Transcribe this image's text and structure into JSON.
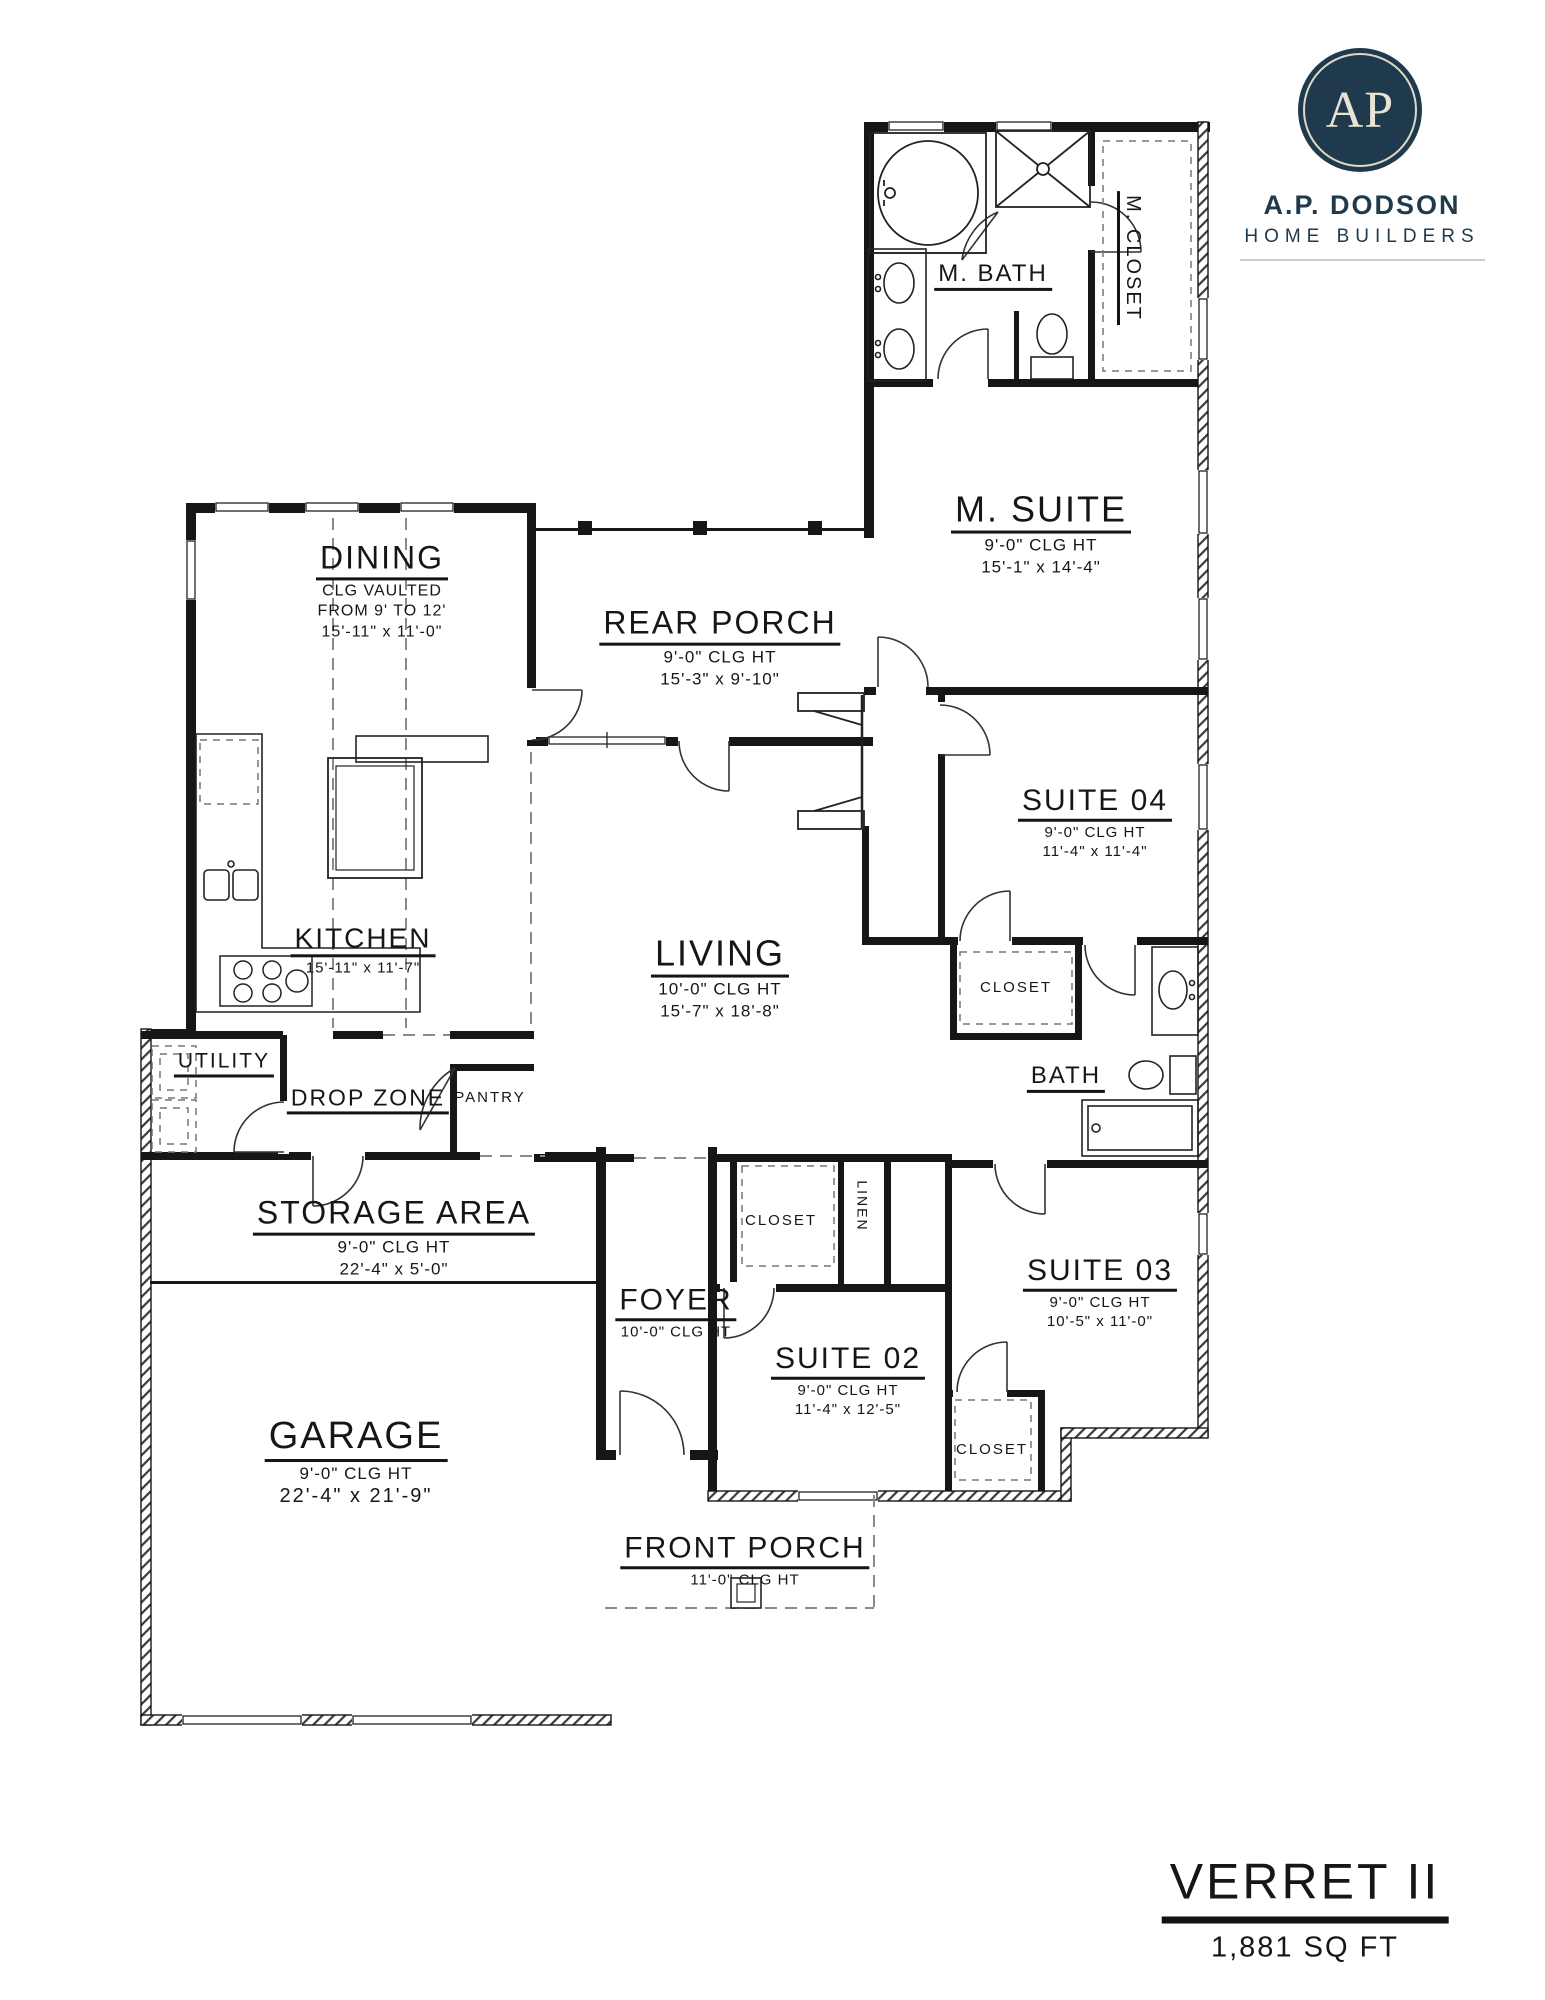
{
  "branding": {
    "logo_monogram": "AP",
    "company_name": "A.P. DODSON",
    "company_tagline": "HOME BUILDERS",
    "brand_color": "#1f3a4c"
  },
  "plan_title": {
    "name": "VERRET II",
    "area": "1,881 SQ FT"
  },
  "colors": {
    "line": "#161616",
    "dash": "#8a8a8a"
  },
  "rooms": {
    "m_bath": {
      "name": "M. BATH"
    },
    "m_closet": {
      "name": "M. CLOSET"
    },
    "m_suite": {
      "name": "M. SUITE",
      "ceiling": "9'-0\" CLG HT",
      "dims": "15'-1\" x 14'-4\""
    },
    "dining": {
      "name": "DINING",
      "ceiling_line1": "CLG VAULTED",
      "ceiling_line2": "FROM 9' TO 12'",
      "dims": "15'-11\" x 11'-0\""
    },
    "rear_porch": {
      "name": "REAR PORCH",
      "ceiling": "9'-0\" CLG HT",
      "dims": "15'-3\" x 9'-10\""
    },
    "suite04": {
      "name": "SUITE 04",
      "ceiling": "9'-0\" CLG HT",
      "dims": "11'-4\" x 11'-4\""
    },
    "kitchen": {
      "name": "KITCHEN",
      "dims": "15'-11\" x 11'-7\""
    },
    "living": {
      "name": "LIVING",
      "ceiling": "10'-0\" CLG HT",
      "dims": "15'-7\" x 18'-8\""
    },
    "closet_suite04": {
      "name": "CLOSET"
    },
    "bath": {
      "name": "BATH"
    },
    "utility": {
      "name": "UTILITY"
    },
    "drop_zone": {
      "name": "DROP ZONE"
    },
    "pantry": {
      "name": "PANTRY"
    },
    "storage": {
      "name": "STORAGE AREA",
      "ceiling": "9'-0\" CLG HT",
      "dims": "22'-4\" x 5'-0\""
    },
    "foyer": {
      "name": "FOYER",
      "ceiling": "10'-0\" CLG HT"
    },
    "closet_foyer": {
      "name": "CLOSET"
    },
    "linen": {
      "name": "LINEN"
    },
    "suite02": {
      "name": "SUITE 02",
      "ceiling": "9'-0\" CLG HT",
      "dims": "11'-4\" x 12'-5\""
    },
    "suite03": {
      "name": "SUITE 03",
      "ceiling": "9'-0\" CLG HT",
      "dims": "10'-5\" x 11'-0\""
    },
    "closet_suite03": {
      "name": "CLOSET"
    },
    "garage": {
      "name": "GARAGE",
      "ceiling": "9'-0\" CLG HT",
      "dims": "22'-4\" x 21'-9\""
    },
    "front_porch": {
      "name": "FRONT PORCH",
      "ceiling": "11'-0\" CLG HT"
    }
  }
}
